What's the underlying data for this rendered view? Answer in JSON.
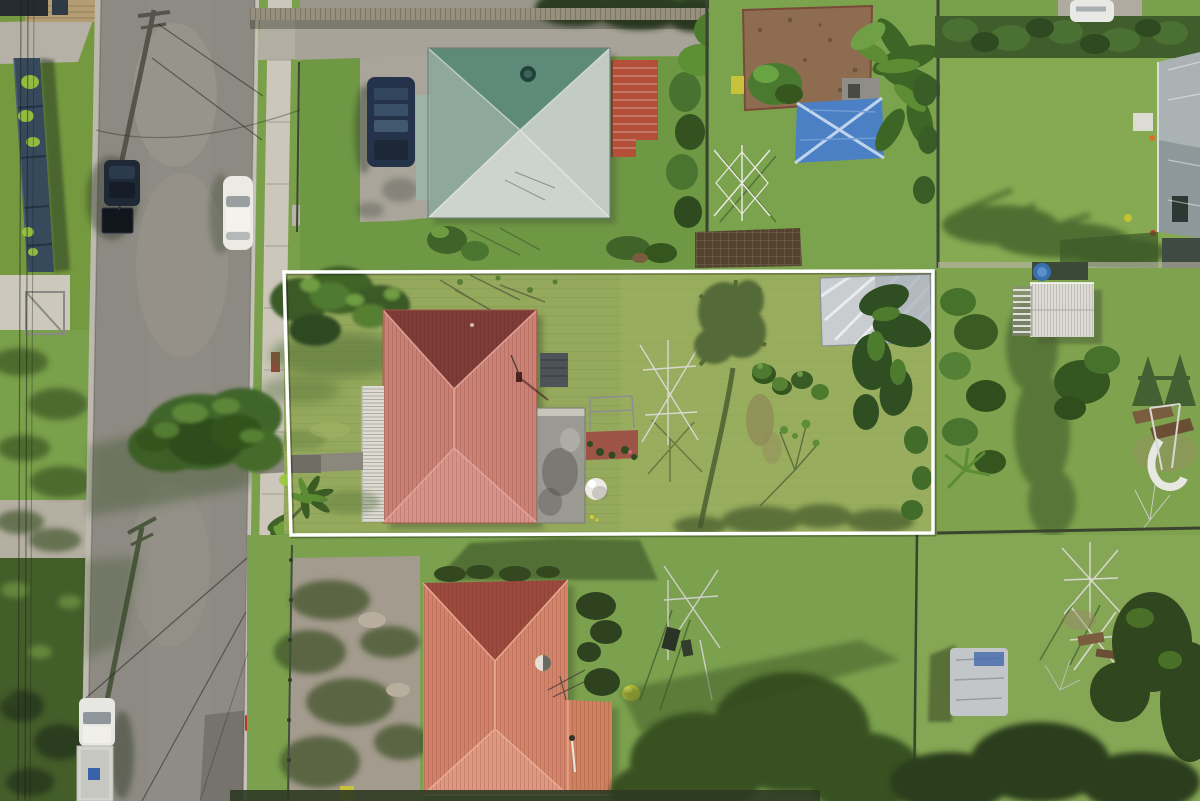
{
  "scene": {
    "type": "aerial-drone-photograph",
    "description": "Top-down aerial photo of a suburban residential block. A white rectangle outlines the featured property: a salmon/terracotta hip-roof house with white verandah strip, grey flat-roof rear extension, large lawn backyard with rotary clothesline, palm-tree shadow and a shade structure. A street runs along the left with parked cars, power-pole shadows and a tall conifer on the verge. A green/teal-roofed house with red carport sits at top, a matching orange-roofed house at bottom, neighbouring yards with sheds, blue tarp, dirt garden plot, play equipment and tarp-covered trailer to the right.",
    "boundary_label": "featured-property-boundary"
  },
  "palette": {
    "grass_base": "#79a04b",
    "grass_front": "#6f9845",
    "grass_featured": "#95a95d",
    "grass_neighbor_top": "#86aa52",
    "grass_neighbor_right": "#7fa24e",
    "grass_south": "#7ba14e",
    "grass_shadow": "#3c5526",
    "road": "#8d8a83",
    "road_patch_dark": "#75736b",
    "kerb": "#bdb9ae",
    "footpath": "#ccc7ba",
    "concrete": "#aaa59b",
    "driveway_south": "#a39b8d",
    "roof_main": "#c88073",
    "roof_main_dark": "#7e3c38",
    "roof_main_light": "#d7928a",
    "verandah_white": "#dddbd2",
    "flat_roof_gray": "#9b9a92",
    "deck_red": "#9e5347",
    "dome_white": "#eceae2",
    "roof_bottom": "#d3846b",
    "roof_bottom_dark": "#9c4a3d",
    "roof_bottom_light": "#de9980",
    "roof_green": "#5e8a7a",
    "roof_green_light": "#cdd4d0",
    "carport_red": "#b4503a",
    "shed_white": "#dcdcd4",
    "tarp_blue": "#4b80c4",
    "dirt_plot": "#8d6c4f",
    "hedge_dark": "#3f5e2c",
    "tree_dark": "#2f4a22",
    "tree_mid": "#4d7631",
    "pine_green": "#41652a",
    "car_white": "#eceae5",
    "car_dark": "#1f2835",
    "ute_white": "#e6e6e2",
    "vehicle_navy": "#24334a",
    "trailer_cover": "#c3c6c9",
    "pool_blue": "#3a6fae",
    "bin_red": "#c2322b",
    "bin_yellow": "#c8c23a",
    "marker_pink": "#bc66a4",
    "slide_white": "#e8e8e2",
    "boundary_white": "#ffffff"
  },
  "objects": {
    "street": "asphalt road with kerbs, power pole shadows and wire shadows",
    "parked_vehicles": [
      "dark SUV with box trailer",
      "white sedan",
      "white ute with tray"
    ],
    "featured_house": "salmon hip roof with dark north face, white corrugated verandah, grey flat-roof extension, red rear deck, white dome tank",
    "backyard_items": [
      "rotary clothesline",
      "palm shadow",
      "shrubs",
      "shade structure with palms"
    ],
    "top_house": "teal/white hip roof with roof vent and red corrugated carport",
    "top_yard_items": [
      "dirt garden plot",
      "blue tarp shelter",
      "white rotary clothesline",
      "palm cluster",
      "soil bed"
    ],
    "right_neighbor_items": [
      "white corrugated shed",
      "blue kiddie pool",
      "kids playset with white slide"
    ],
    "bottom_house": "orange hip roof with vent, antenna and right annex",
    "bottom_yard_items": [
      "rotary clothesline with washing",
      "tarp-covered trailer",
      "timber frames",
      "yellow wheelie bin"
    ],
    "street_furniture": [
      "red bin at kerb",
      "pink marker",
      "letterbox",
      "tall conifer on verge"
    ]
  }
}
